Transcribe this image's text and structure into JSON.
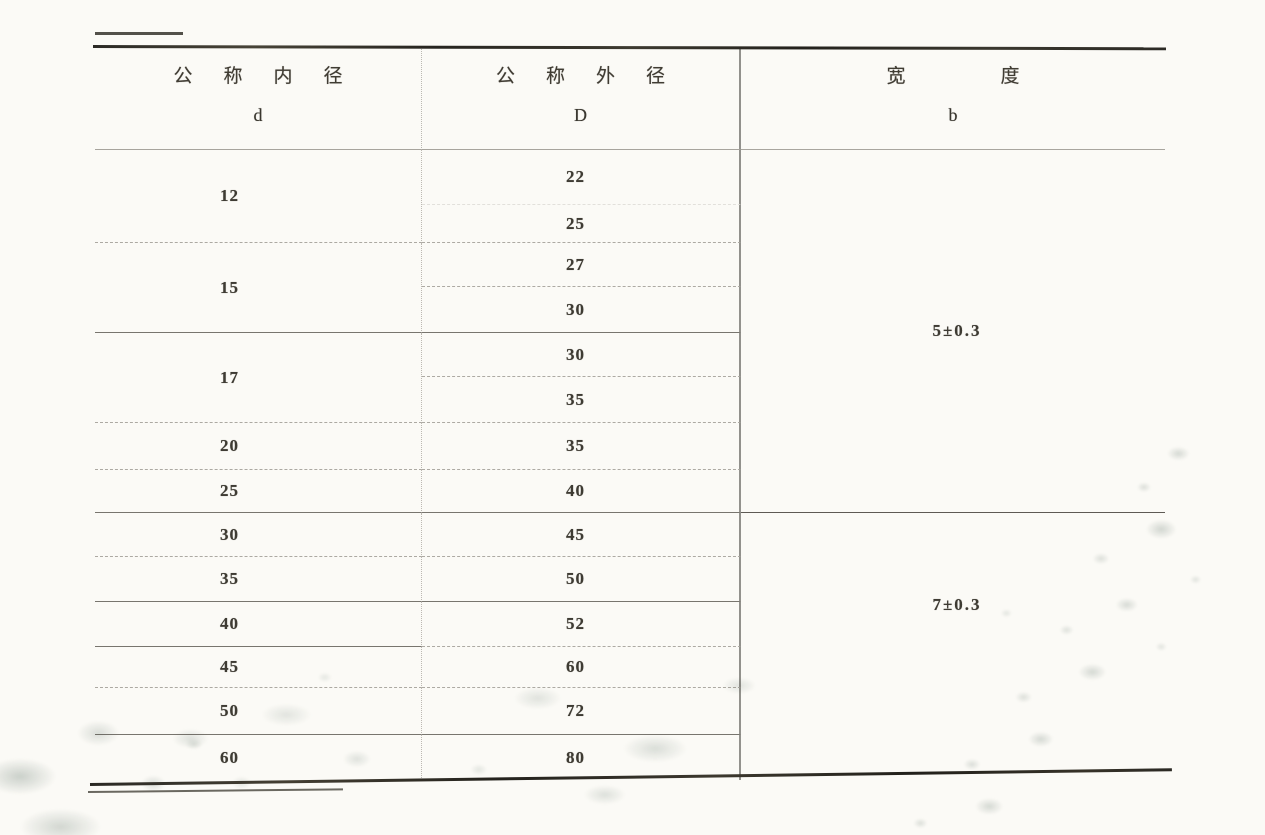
{
  "page": {
    "background_color": "#fbfaf6",
    "ink_color": "#3e3b33",
    "stain_color": "#aab4ac"
  },
  "table": {
    "columns": [
      {
        "id": "d",
        "title": "公称内径",
        "symbol": "d"
      },
      {
        "id": "D",
        "title": "公称外径",
        "symbol": "D"
      },
      {
        "id": "b",
        "title": "宽度",
        "symbol": "b"
      }
    ],
    "groups": [
      {
        "d": "12",
        "D": [
          "22",
          "25"
        ]
      },
      {
        "d": "15",
        "D": [
          "27",
          "30"
        ]
      },
      {
        "d": "17",
        "D": [
          "30",
          "35"
        ]
      },
      {
        "d": "20",
        "D": [
          "35"
        ]
      },
      {
        "d": "25",
        "D": [
          "40"
        ]
      },
      {
        "d": "30",
        "D": [
          "45"
        ]
      },
      {
        "d": "35",
        "D": [
          "50"
        ]
      },
      {
        "d": "40",
        "D": [
          "52"
        ]
      },
      {
        "d": "45",
        "D": [
          "60"
        ]
      },
      {
        "d": "50",
        "D": [
          "72"
        ]
      },
      {
        "d": "60",
        "D": [
          "80"
        ]
      }
    ],
    "width_groups": [
      {
        "b": "5±0.3",
        "applies_to_d": [
          "12",
          "15",
          "17",
          "20",
          "25"
        ]
      },
      {
        "b": "7±0.3",
        "applies_to_d": [
          "30",
          "35",
          "40",
          "45",
          "50",
          "60"
        ]
      }
    ]
  }
}
